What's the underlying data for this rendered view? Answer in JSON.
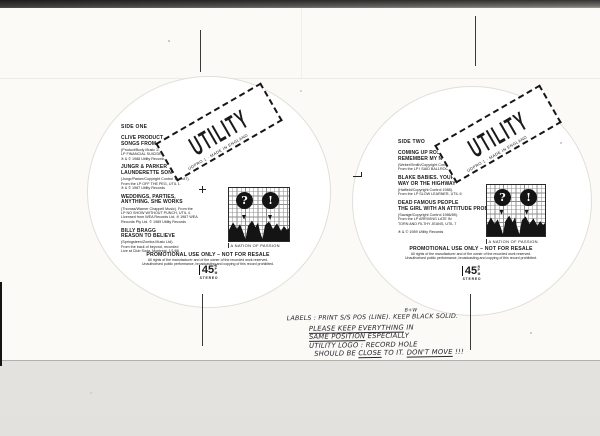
{
  "colors": {
    "ink": "#141414",
    "sheet": "#fbfaf7",
    "scanner_bed": "#e9e7e3"
  },
  "logo": {
    "text": "UTILITY",
    "caption": "UDPRO 1 · MADE IN ENGLAND"
  },
  "nation": {
    "question": "?",
    "exclaim": "!",
    "caption": "A NATION OF PASSION"
  },
  "promo": {
    "title": "PROMOTIONAL USE ONLY – NOT FOR RESALE",
    "fine1": "All rights of the manufacturer and of the owner of the recorded work reserved.",
    "fine2": "Unauthorised public performance, broadcasting and copying of this record prohibited."
  },
  "badge": {
    "speed": "45",
    "unit": "RPM",
    "stereo": "STEREO"
  },
  "side_one": {
    "label": "SIDE ONE",
    "tracks": [
      {
        "artist": "CLIVE PRODUCT",
        "title": "SONGS FROM AN UNTIDY BEDROOM",
        "credits": "(Product/Body Music 1986). From the\nLP FINANCIAL SUICIDE, UTIL 2.\n℗ & © 1988 Utility Records"
      },
      {
        "artist": "JUNGR & PARKER",
        "title": "LAUNDERETTE SONG",
        "credits": "(Jungr/Parker/Copyright Control 1985/87).\nFrom the LP OFF THE PEG, UTIL 1.\n℗ & © 1987 Utility Records"
      },
      {
        "artist": "WEDDINGS, PARTIES,",
        "title": "ANYTHING. SHE WORKS",
        "credits": "(Thomas/Warner Chappell Music). From the\nLP NO SHOW WITHOUT PUNCH, UTIL 4.\nLicensed from WEA Records Ltd. ℗ 1987 WEA\nRecords Pty Ltd. © 1989 Utility Records"
      },
      {
        "artist": "BILLY BRAGG",
        "title": "REASON TO BELIEVE",
        "credits": "(Springsteen/Zomba Music Ltd).\nFrom the back of beyond, recorded\nLive at Club Soda, Montreal, 1/1/88"
      }
    ]
  },
  "side_two": {
    "label": "SIDE TWO",
    "tracks": [
      {
        "artist": "COMING UP ROSES",
        "title": "REMEMBER MY NAME",
        "credits": "(Weber/Smith/Copyright Control 1985/89).\nFrom the LP I SAID BALLROOM, UTIL 3"
      },
      {
        "artist": "BLAKE BABIES. YOUR",
        "title": "WAY OR THE HIGHWAY",
        "credits": "(Hatfield/Copyright Control 1988).\nFrom the LP SLOW LEARNER, UTIL 6"
      },
      {
        "artist": "DEAD FAMOUS PEOPLE",
        "title": "THE GIRL WITH AN ATTITUDE PROBLEM",
        "credits": "(Savage/Copyright Control 1986/89).\nFrom the LP ARRIVING LATE IN\nTORN AND FILTHY JEANS, UTIL 7"
      }
    ],
    "footer": "℗ & © 1989 Utility Records"
  },
  "handwriting": {
    "insert": "B+W",
    "l1": "LABELS : PRINT S/S POS (LINE). KEEP BLACK SOLID.",
    "l2a": "PLEASE KEEP EVERYTHING",
    "l2b": " IN",
    "l3a": "SAME POSITION",
    "l3b": " ESPECIALLY",
    "l4": "UTILITY LOGO : RECORD HOLE",
    "l5a": "SHOULD BE ",
    "l5b": "CLOSE",
    "l5c": " TO IT. ",
    "l5d": "DON'T MOVE",
    "l5e": " !!!"
  }
}
